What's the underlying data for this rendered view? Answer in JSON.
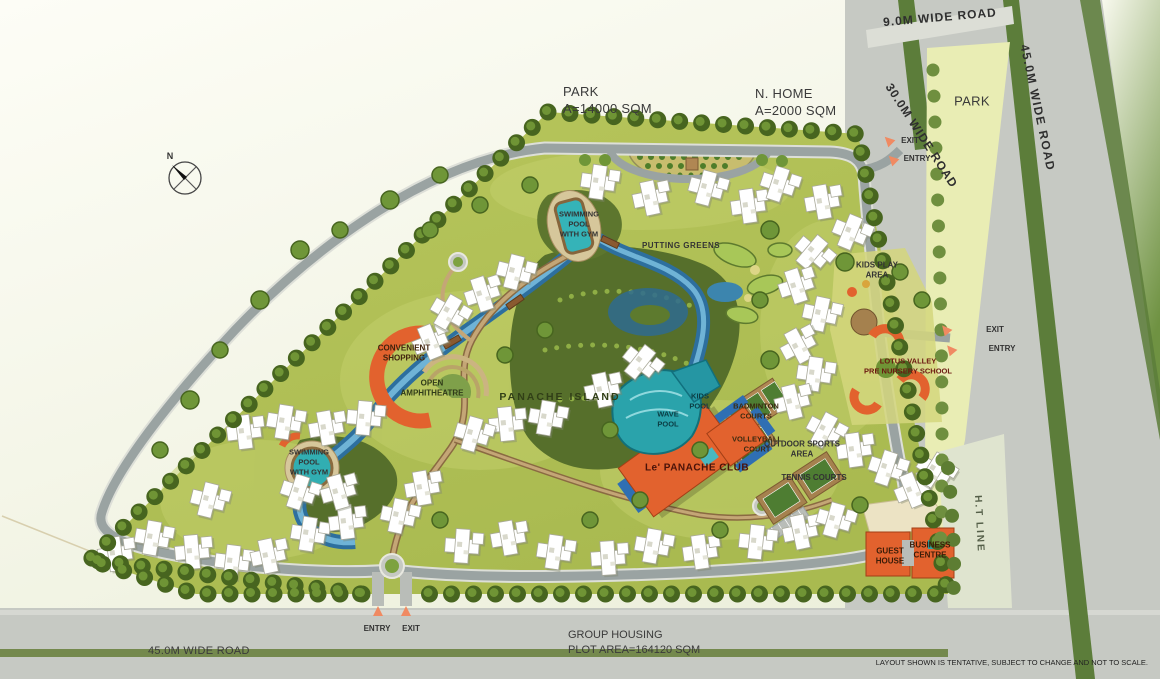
{
  "compass": {
    "north": "N"
  },
  "corner_labels": {
    "park_top_1": "PARK",
    "park_top_2": "A=14000 SQM",
    "n_home_1": "N. HOME",
    "n_home_2": "A=2000 SQM",
    "park_right": "PARK",
    "group_housing_1": "GROUP HOUSING",
    "group_housing_2": "PLOT AREA=164120 SQM",
    "disclaimer": "LAYOUT SHOWN IS TENTATIVE, SUBJECT TO CHANGE AND NOT TO SCALE."
  },
  "roads": {
    "r9": "9.0M WIDE ROAD",
    "r45_right": "45.0M WIDE ROAD",
    "r30": "30.0M WIDE ROAD",
    "r45_bottom": "45.0M WIDE ROAD",
    "ht": "H.T LINE"
  },
  "gates": {
    "top_exit": "EXIT",
    "top_entry": "ENTRY",
    "right_exit": "EXIT",
    "right_entry": "ENTRY",
    "bottom_entry": "ENTRY",
    "bottom_exit": "EXIT"
  },
  "amenities": {
    "pool_north": [
      "SWIMMING",
      "POOL",
      "WITH GYM"
    ],
    "putting_greens": "PUTTING GREENS",
    "kids_play": [
      "KIDS PLAY",
      "AREA"
    ],
    "school": [
      "LOTUS VALLEY",
      "PRE NURSERY SCHOOL"
    ],
    "island": "PANACHE ISLAND",
    "kids_pool": [
      "KIDS",
      "POOL"
    ],
    "wave_pool": [
      "WAVE",
      "POOL"
    ],
    "club": "Le' PANACHE CLUB",
    "badminton": [
      "BADMINTON",
      "COURTS"
    ],
    "volleyball": [
      "VOLLEYBALL",
      "COURT"
    ],
    "outdoor_sports": [
      "OUTDOOR SPORTS",
      "AREA"
    ],
    "tennis": "TENNIS COURTS",
    "shopping": [
      "CONVENIENT",
      "SHOPPING"
    ],
    "amphitheatre": [
      "OPEN",
      "AMPHITHEATRE"
    ],
    "pool_west": [
      "SWIMMING",
      "POOL",
      "WITH GYM"
    ],
    "guest_house": [
      "GUEST",
      "HOUSE"
    ],
    "business_centre": [
      "BUSINESS",
      "CENTRE"
    ]
  },
  "colors": {
    "site_green": "#b0bf55",
    "border_tree": "#47651f",
    "water": "#3c85ae",
    "pool_teal": "#2ba3a8",
    "club_orange": "#e2622e",
    "road_gray": "#c6c9c3",
    "inner_road": "#9aa3a2",
    "park_pale": "#e9edb4",
    "accent_arrow": "#f08a62"
  }
}
